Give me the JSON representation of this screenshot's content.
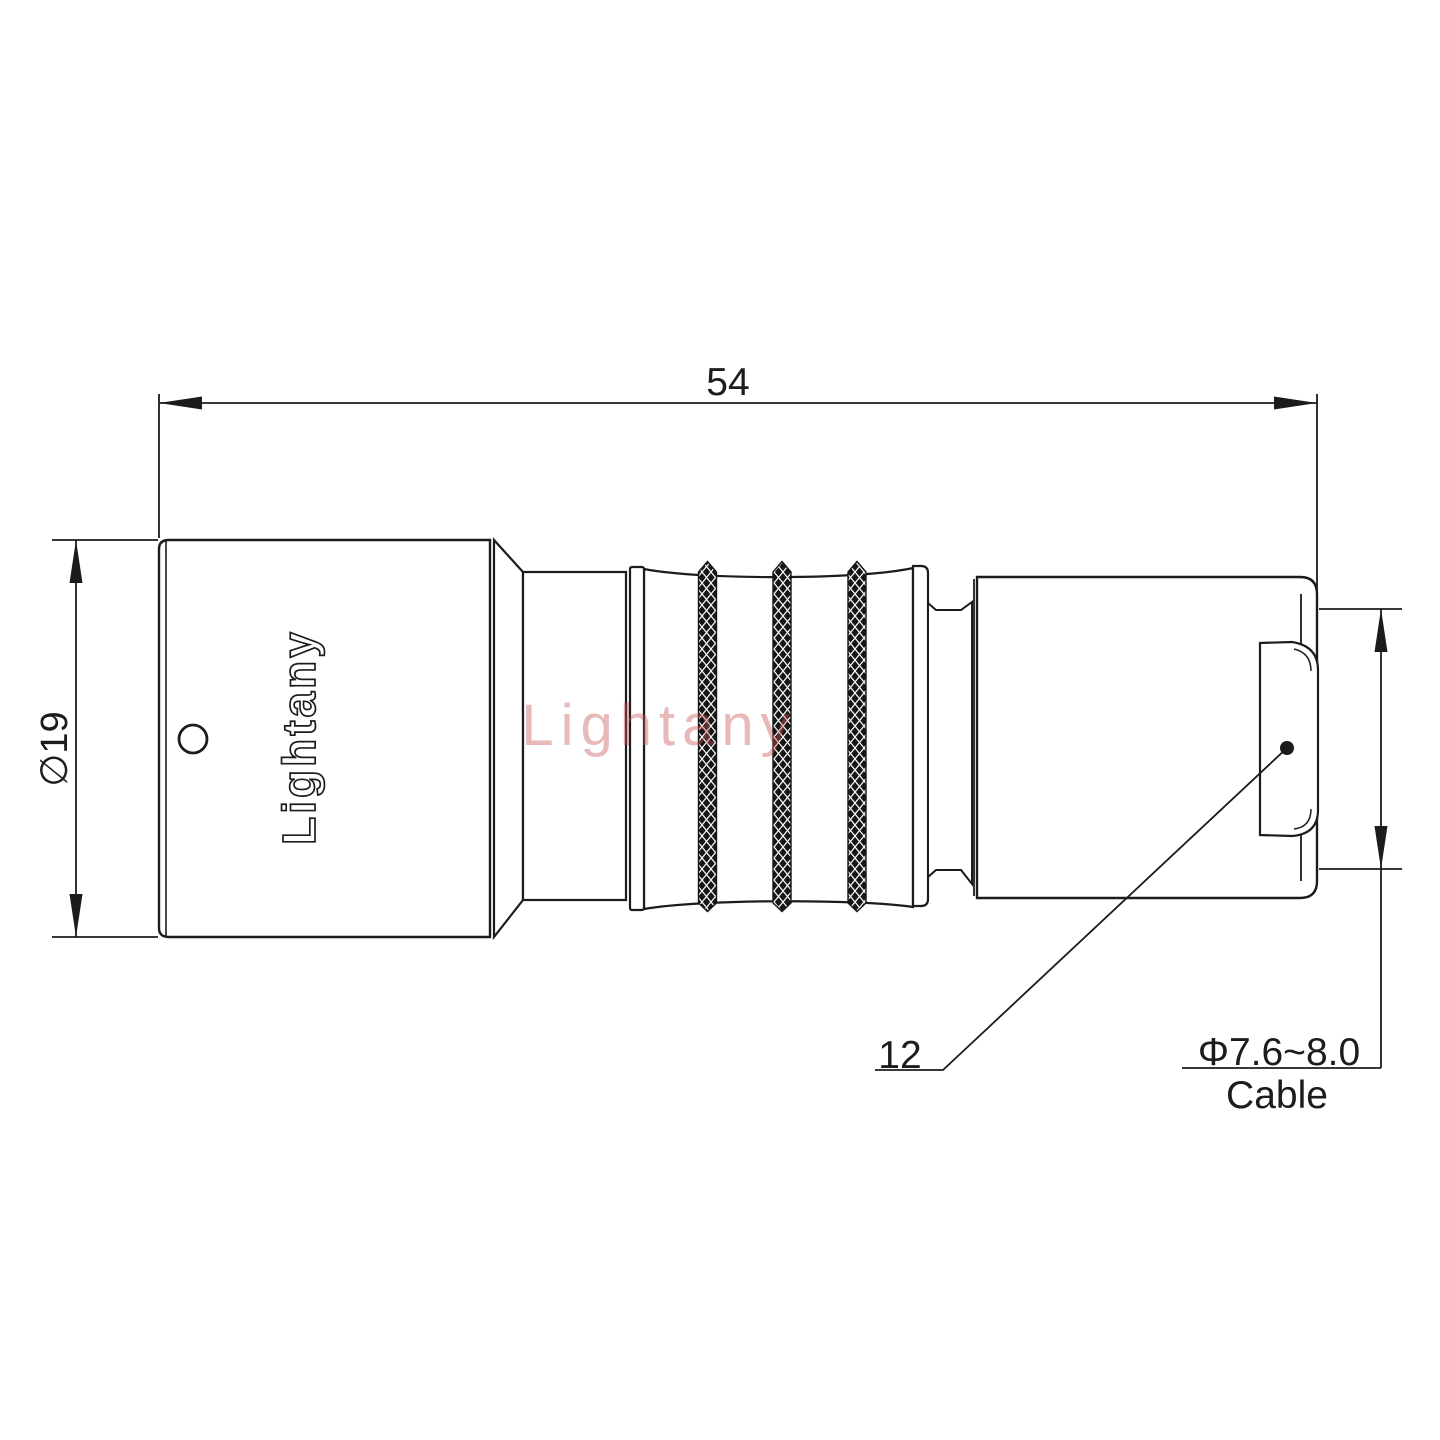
{
  "drawing": {
    "type": "connector-technical-drawing",
    "brand_engraving": "Lightany",
    "watermark_text": "Lightany",
    "dimensions": {
      "overall_length": {
        "value": "54"
      },
      "body_diameter": {
        "value": "∅19"
      },
      "boot_length": {
        "value": "12"
      },
      "cable_diameter": {
        "value": "Φ7.6~8.0",
        "label": "Cable"
      }
    },
    "colors": {
      "line": "#1c1c1c",
      "background": "#ffffff",
      "watermark": "#cb5555",
      "knurl_fill": "#161616"
    }
  }
}
